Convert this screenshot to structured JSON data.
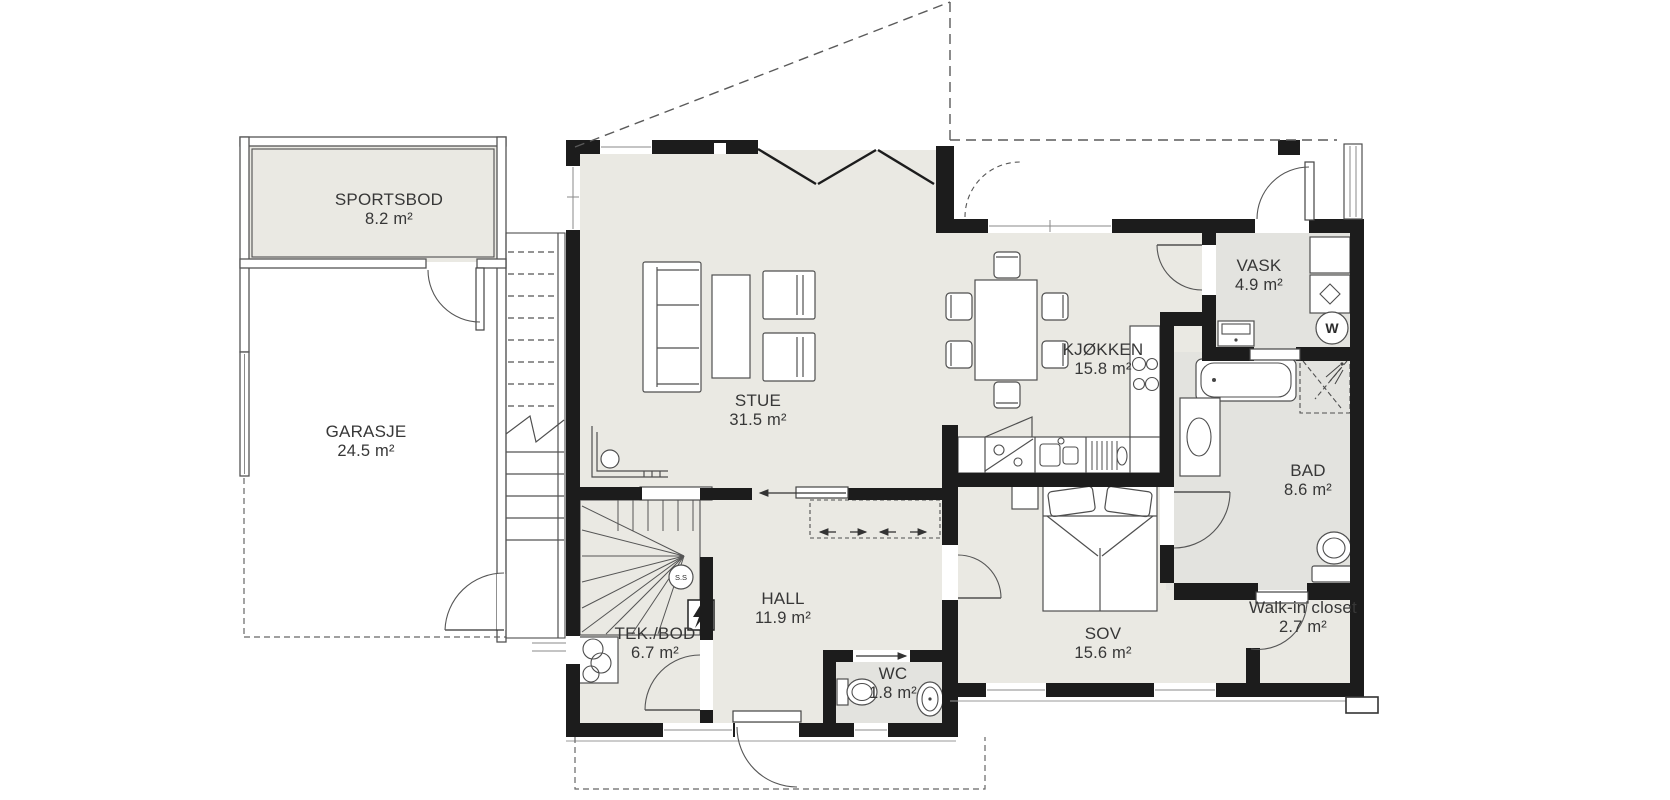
{
  "floorplan": {
    "rooms": [
      {
        "id": "sportsbod",
        "name": "SPORTSBOD",
        "area": "8.2 m²"
      },
      {
        "id": "garasje",
        "name": "GARASJE",
        "area": "24.5 m²"
      },
      {
        "id": "stue",
        "name": "STUE",
        "area": "31.5 m²"
      },
      {
        "id": "kjokken",
        "name": "KJØKKEN",
        "area": "15.8 m²"
      },
      {
        "id": "vask",
        "name": "VASK",
        "area": "4.9 m²"
      },
      {
        "id": "bad",
        "name": "BAD",
        "area": "8.6 m²"
      },
      {
        "id": "hall",
        "name": "HALL",
        "area": "11.9 m²"
      },
      {
        "id": "tek_bod",
        "name": "TEK./BOD",
        "area": "6.7 m²"
      },
      {
        "id": "wc",
        "name": "WC",
        "area": "1.8 m²"
      },
      {
        "id": "sov",
        "name": "SOV",
        "area": "15.6 m²"
      },
      {
        "id": "walk_in_closet",
        "name": "Walk-in closet",
        "area": "2.7 m²"
      }
    ],
    "symbols": {
      "washing_machine": "W",
      "stair_landing": "S.S",
      "electrical_panel": "⚡"
    },
    "colors": {
      "wall": "#1c1c1c",
      "floor": "#eae9e3",
      "floor_wet": "#e3e3df",
      "line": "#555555",
      "dashed": "#666666"
    }
  }
}
